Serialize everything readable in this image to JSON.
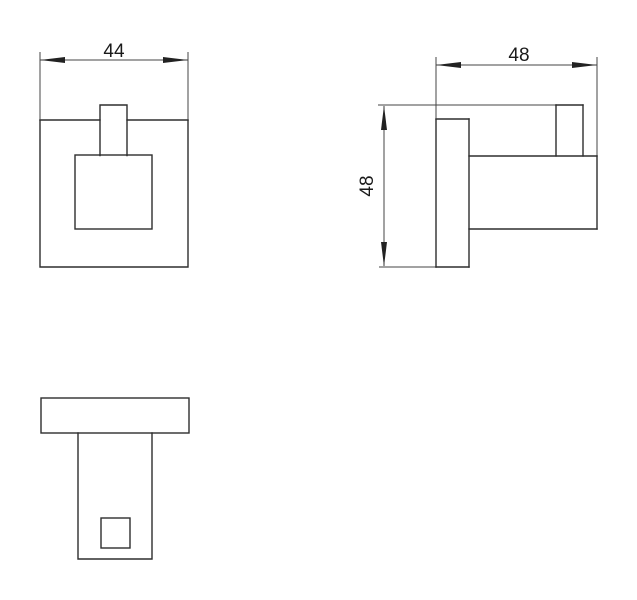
{
  "drawing": {
    "background": "#ffffff",
    "line_color": "#2e2e2e",
    "dim_line_color": "#444444",
    "text_color": "#1a1a1a",
    "views": {
      "front": {
        "width_dim": "44"
      },
      "side": {
        "depth_dim": "48",
        "height_dim": "48"
      }
    }
  }
}
